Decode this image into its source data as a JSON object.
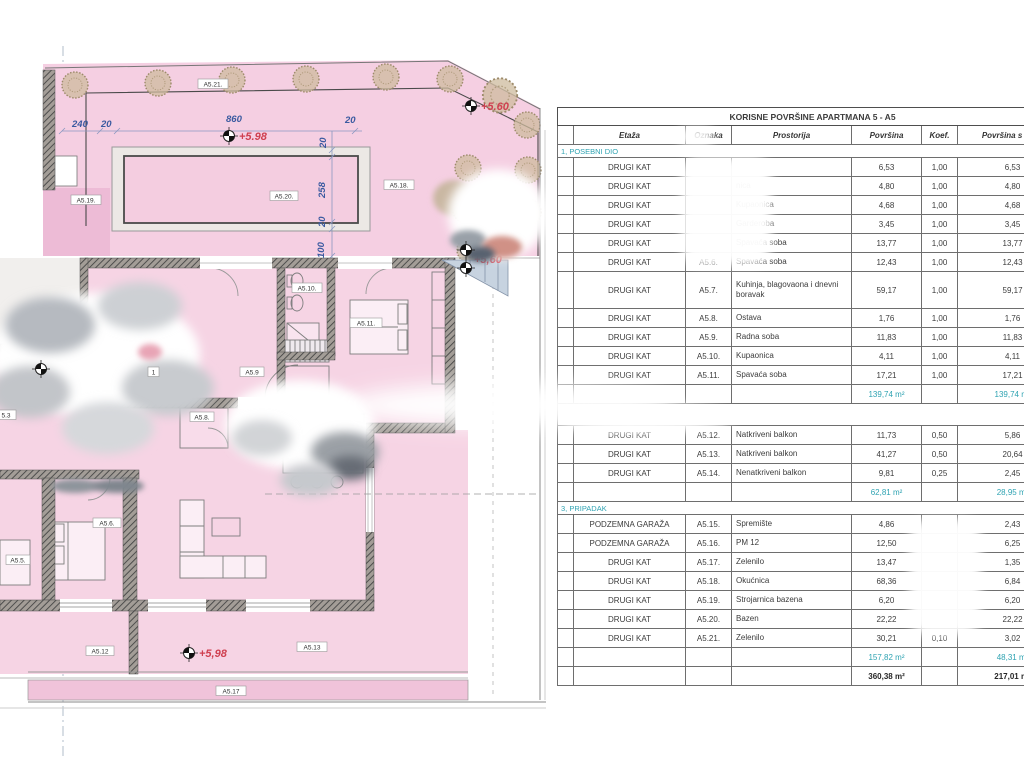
{
  "plan": {
    "dims": {
      "d1": "240",
      "d2": "20",
      "d3": "860",
      "d4": "20",
      "d5": "20",
      "d6": "258",
      "d7": "20",
      "d8": "100"
    },
    "elev": {
      "e1": "+5.98",
      "e2": "+5.60",
      "e3": "+5,60",
      "e4": "+5,98"
    },
    "labels": {
      "a521": "A5.21.",
      "a519": "A5.19.",
      "a520": "A5.20.",
      "a518": "A5.18.",
      "a510": "A5.10.",
      "a511": "A5.11.",
      "a59": "A5.9",
      "a58": "A5.8.",
      "a53": "5.3",
      "a55": "A5.5.",
      "a56": "A5.6.",
      "door1": "1",
      "a512": "A5.12",
      "a513": "A5.13",
      "a517": "A5.17"
    }
  },
  "table": {
    "title": "KORISNE POVRŠINE APARTMANA 5 - A5",
    "columns": {
      "etaza": "Etaža",
      "oznaka": "Oznaka",
      "prostorija": "Prostorija",
      "povrsina": "Površina",
      "koef": "Koef.",
      "povrsina_k": "Površina s koef."
    },
    "sections": [
      {
        "header": "1, POSEBNI DIO",
        "rows": [
          {
            "etaza": "DRUGI KAT",
            "oznaka": "",
            "prostorija": "",
            "povrsina": "6,53",
            "koef": "1,00",
            "povrsina_k": "6,53"
          },
          {
            "etaza": "DRUGI KAT",
            "oznaka": "",
            "prostorija": "nica",
            "povrsina": "4,80",
            "koef": "1,00",
            "povrsina_k": "4,80"
          },
          {
            "etaza": "DRUGI KAT",
            "oznaka": "",
            "prostorija": "Kupaonica",
            "povrsina": "4,68",
            "koef": "1,00",
            "povrsina_k": "4,68"
          },
          {
            "etaza": "DRUGI KAT",
            "oznaka": "",
            "prostorija": "Garderoba",
            "povrsina": "3,45",
            "koef": "1,00",
            "povrsina_k": "3,45"
          },
          {
            "etaza": "DRUGI KAT",
            "oznaka": "",
            "prostorija": "Spavaća soba",
            "povrsina": "13,77",
            "koef": "1,00",
            "povrsina_k": "13,77"
          },
          {
            "etaza": "DRUGI KAT",
            "oznaka": "A5.6.",
            "prostorija": "Spavaća soba",
            "povrsina": "12,43",
            "koef": "1,00",
            "povrsina_k": "12,43"
          },
          {
            "etaza": "DRUGI KAT",
            "oznaka": "A5.7.",
            "prostorija": "Kuhinja, blagovaona i dnevni boravak",
            "povrsina": "59,17",
            "koef": "1,00",
            "povrsina_k": "59,17",
            "tall": true
          },
          {
            "etaza": "DRUGI KAT",
            "oznaka": "A5.8.",
            "prostorija": "Ostava",
            "povrsina": "1,76",
            "koef": "1,00",
            "povrsina_k": "1,76"
          },
          {
            "etaza": "DRUGI KAT",
            "oznaka": "A5.9.",
            "prostorija": "Radna soba",
            "povrsina": "11,83",
            "koef": "1,00",
            "povrsina_k": "11,83"
          },
          {
            "etaza": "DRUGI KAT",
            "oznaka": "A5.10.",
            "prostorija": "Kupaonica",
            "povrsina": "4,11",
            "koef": "1,00",
            "povrsina_k": "4,11"
          },
          {
            "etaza": "DRUGI KAT",
            "oznaka": "A5.11.",
            "prostorija": "Spavaća soba",
            "povrsina": "17,21",
            "koef": "1,00",
            "povrsina_k": "17,21"
          }
        ],
        "subtotal": {
          "povrsina": "139,74 m²",
          "povrsina_k": "139,74 m²"
        }
      },
      {
        "header": "",
        "rows": [
          {
            "etaza": "DRUGI KAT",
            "oznaka": "A5.12.",
            "prostorija": "Natkriveni balkon",
            "povrsina": "11,73",
            "koef": "0,50",
            "povrsina_k": "5,86"
          },
          {
            "etaza": "DRUGI KAT",
            "oznaka": "A5.13.",
            "prostorija": "Natkriveni balkon",
            "povrsina": "41,27",
            "koef": "0,50",
            "povrsina_k": "20,64"
          },
          {
            "etaza": "DRUGI KAT",
            "oznaka": "A5.14.",
            "prostorija": "Nenatkriveni balkon",
            "povrsina": "9,81",
            "koef": "0,25",
            "povrsina_k": "2,45"
          }
        ],
        "subtotal": {
          "povrsina": "62,81 m²",
          "povrsina_k": "28,95 m²"
        }
      },
      {
        "header": "3, PRIPADAK",
        "rows": [
          {
            "etaza": "PODZEMNA GARAŽA",
            "oznaka": "A5.15.",
            "prostorija": "Spremište",
            "povrsina": "4,86",
            "koef": "",
            "povrsina_k": "2,43"
          },
          {
            "etaza": "PODZEMNA GARAŽA",
            "oznaka": "A5.16.",
            "prostorija": "PM 12",
            "povrsina": "12,50",
            "koef": "",
            "povrsina_k": "6,25"
          },
          {
            "etaza": "DRUGI KAT",
            "oznaka": "A5.17.",
            "prostorija": "Zelenilo",
            "povrsina": "13,47",
            "koef": "",
            "povrsina_k": "1,35"
          },
          {
            "etaza": "DRUGI KAT",
            "oznaka": "A5.18.",
            "prostorija": "Okućnica",
            "povrsina": "68,36",
            "koef": "",
            "povrsina_k": "6,84"
          },
          {
            "etaza": "DRUGI KAT",
            "oznaka": "A5.19.",
            "prostorija": "Strojarnica bazena",
            "povrsina": "6,20",
            "koef": "",
            "povrsina_k": "6,20"
          },
          {
            "etaza": "DRUGI KAT",
            "oznaka": "A5.20.",
            "prostorija": "Bazen",
            "povrsina": "22,22",
            "koef": "",
            "povrsina_k": "22,22"
          },
          {
            "etaza": "DRUGI KAT",
            "oznaka": "A5.21.",
            "prostorija": "Zelenilo",
            "povrsina": "30,21",
            "koef": "0,10",
            "povrsina_k": "3,02"
          }
        ],
        "subtotal": {
          "povrsina": "157,82 m²",
          "povrsina_k": "48,31 m²"
        },
        "total": {
          "povrsina": "360,38 m²",
          "povrsina_k": "217,01 m²"
        }
      }
    ]
  }
}
